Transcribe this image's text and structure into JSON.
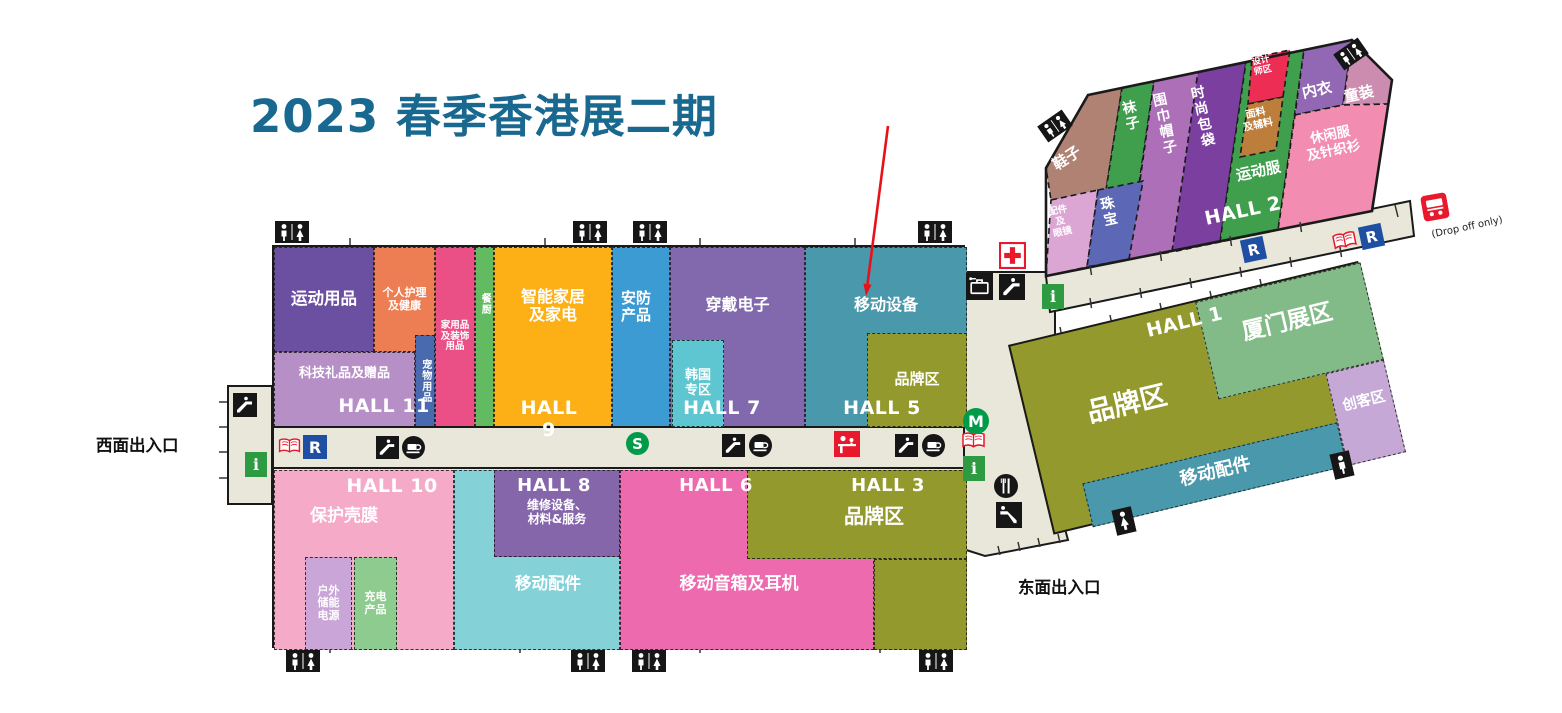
{
  "title": "2023 春季香港展二期",
  "entrances": {
    "west": "西面出入口",
    "east": "东面出入口"
  },
  "drop_off_note": "(Drop off only)",
  "halls": {
    "h1": "HALL 1",
    "h2": "HALL 2",
    "h3": "HALL 3",
    "h5": "HALL 5",
    "h6": "HALL 6",
    "h7": "HALL 7",
    "h8": "HALL 8",
    "h9": "HALL 9",
    "h10": "HALL 10",
    "h11": "HALL 11"
  },
  "regions": {
    "sports": "运动用品",
    "personal_care": "个人护理\n及健康",
    "tech_gifts": "科技礼品及赠品",
    "pets": "宠物用品",
    "household": "家用品\n及装饰\n用品",
    "kitchen": "餐厨",
    "smart_home": "智能家居\n及家电",
    "security": "安防\n产品",
    "wearables": "穿戴电子",
    "korea": "韩国\n专区",
    "mobile_devices": "移动设备",
    "brand_h5": "品牌区",
    "cases": "保护壳膜",
    "outdoor_power": "户外\n储能\n电源",
    "charging": "充电\n产品",
    "repair": "维修设备、\n材料&服务",
    "mobile_acc_h8": "移动配件",
    "speakers": "移动音箱及耳机",
    "brand_h3": "品牌区",
    "brand_h1": "品牌区",
    "xiamen": "厦门展区",
    "maker": "创客区",
    "mobile_acc_h1": "移动配件",
    "shoes": "鞋子",
    "socks": "袜子",
    "scarves": "围巾帽子",
    "bags": "时尚包袋",
    "designer": "设计\n师区",
    "fabrics": "面料\n及辅料",
    "underwear": "内衣",
    "kids": "童装",
    "sportswear": "运动服",
    "casual": "休闲服\n及针织衫",
    "acc_eyewear": "配件\n及\n眼镜",
    "jewelry": "珠宝"
  },
  "icon_letters": {
    "restaurant": "R",
    "info": "i",
    "mtr": "M",
    "station": "S"
  },
  "colors": {
    "title_blue": "#19688F",
    "arrow_red": "#E8111A",
    "corridor": "#E8E7DA",
    "outline": "#1A1A1A",
    "icon_green": "#2E9B43",
    "icon_blue": "#1E4FA3",
    "icon_red": "#E8192C",
    "circle_green": "#009B48",
    "sports": "#6B4FA0",
    "personal_care": "#ED7D52",
    "tech_gifts": "#B78FC7",
    "pets": "#4A6AB0",
    "household": "#EA4F86",
    "kitchen": "#62BB60",
    "smart_home": "#FCB016",
    "security": "#3D9BD3",
    "wearables": "#8269AE",
    "korea": "#5EC6D0",
    "mobile_devices": "#4A98AB",
    "brand": "#93992C",
    "cases": "#F5AAC7",
    "outdoor_power": "#C9A5D8",
    "charging": "#8ECB8F",
    "repair": "#8566AB",
    "mobile_acc_h8": "#84D1D8",
    "speakers": "#EE6AAE",
    "xiamen": "#82BB88",
    "maker": "#C5A8D6",
    "mobile_acc_h1": "#4A98AB",
    "shoes": "#B08273",
    "socks": "#3F9F4D",
    "scarves": "#AD6FB7",
    "bags": "#7B3FA0",
    "designer": "#EE2D55",
    "fabrics": "#BD7E3C",
    "underwear": "#9268B5",
    "kids": "#CC8CB0",
    "sportswear": "#3F9F4D",
    "casual": "#F28CB0",
    "acc_eyewear": "#DCA6D4",
    "jewelry": "#5C68B5"
  }
}
